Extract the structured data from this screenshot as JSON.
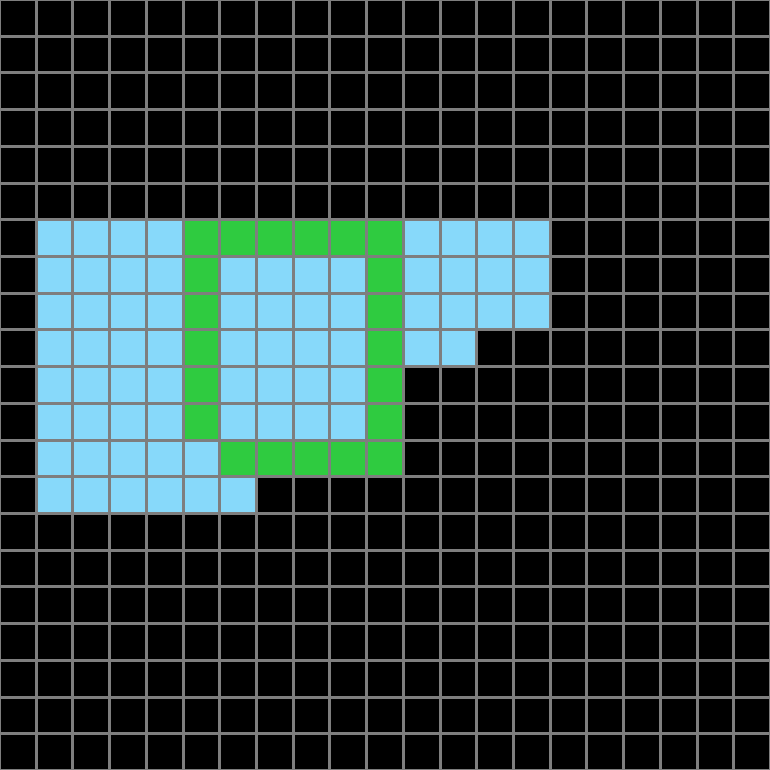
{
  "board": {
    "rows": 21,
    "cols": 21,
    "background_color": "#000000",
    "gridline_color": "#7E7E7E",
    "colors": {
      "empty": "#000000",
      "blue": "#87D9FA",
      "green": "#2FCB40"
    },
    "legend": {
      ".": "empty",
      "B": "blue",
      "G": "green"
    },
    "cells": [
      ".....................",
      ".....................",
      ".....................",
      ".....................",
      ".....................",
      ".....................",
      ".BBBBGGGGGGBBBB......",
      ".BBBBGBBBBGBBBB......",
      ".BBBBGBBBBGBBBB......",
      ".BBBBGBBBBGBB........",
      ".BBBBGBBBBG..........",
      ".BBBBGBBBBG..........",
      ".BBBBBGGGGG..........",
      ".BBBBBB..............",
      ".....................",
      ".....................",
      ".....................",
      ".....................",
      ".....................",
      ".....................",
      "....................."
    ]
  }
}
